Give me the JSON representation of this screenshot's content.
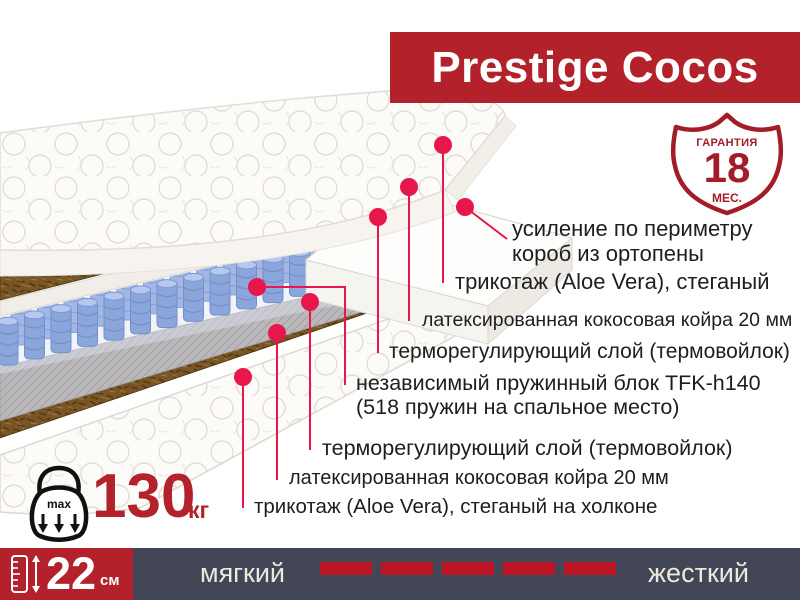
{
  "theme": {
    "accent": "#b3212b",
    "badge": "#a31d28",
    "callout": "#e8174b",
    "bar_bg": "#434656",
    "dash": "#bc1626",
    "cream": "#ece9dd",
    "text": "#1e1e1e"
  },
  "banner": {
    "title": "Prestige Cocos"
  },
  "warranty_badge": {
    "label": "ГАРАНТИЯ",
    "value": "18",
    "unit": "МЕС."
  },
  "layer_labels": [
    {
      "l1": "усиление по периметру",
      "l2": "короб из ортопены"
    },
    {
      "l1": "трикотаж (Aloe Vera), стеганый"
    },
    {
      "l1": "латексированная кокосовая койра 20 мм"
    },
    {
      "l1": "терморегулирующий слой (термовойлок)"
    },
    {
      "l1": "независимый пружинный блок TFK-h140",
      "l2": "(518 пружин на спальное место)"
    },
    {
      "l1": "терморегулирующий слой (термовойлок)"
    },
    {
      "l1": "латексированная кокосовая койра 20 мм"
    },
    {
      "l1": "трикотаж (Aloe Vera), стеганый на холконе"
    }
  ],
  "max_weight": {
    "badge_text": "max",
    "value": "130",
    "unit": "кг"
  },
  "height_block": {
    "value": "22",
    "unit": "см"
  },
  "firmness": {
    "soft": "мягкий",
    "hard": "жесткий",
    "dash_count": 5
  }
}
